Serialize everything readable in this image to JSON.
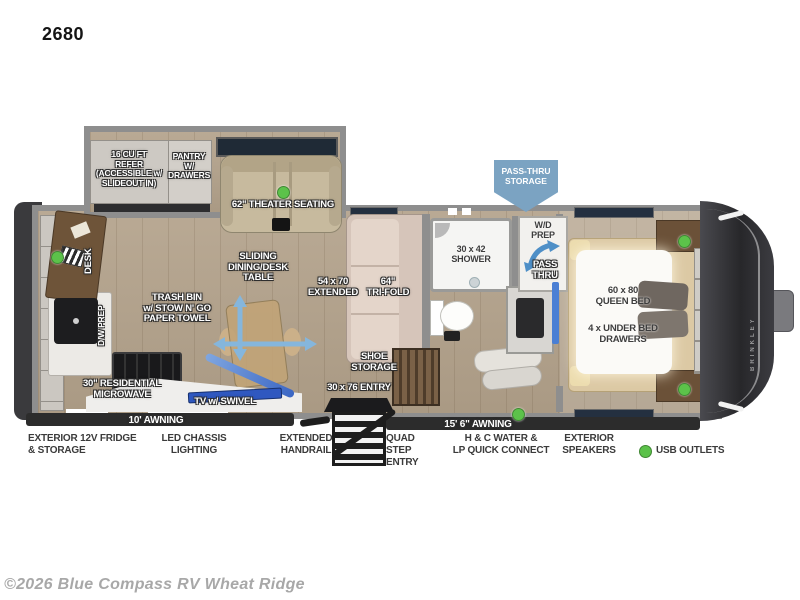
{
  "title": "2680",
  "copyright": "©2026 Blue Compass RV Wheat Ridge",
  "callouts": {
    "pass_thru_storage": "PASS-THRU\nSTORAGE"
  },
  "interior": {
    "refer": "16 CU FT\nREFER\n(ACCESSIBLE w/\nSLIDEOUT IN)",
    "pantry": "PANTRY\nW/\nDRAWERS",
    "theater": "62\" THEATER SEATING",
    "sliding_table": "SLIDING\nDINING/DESK\nTABLE",
    "extended_table": "54 x 70\nEXTENDED",
    "trifold": "64\"\nTRI-FOLD",
    "trash_bin": "TRASH BIN\nw/ STOW N' GO\nPAPER TOWEL",
    "desk": "DESK",
    "dw_prep": "D/W PREP",
    "microwave": "30\" RESIDENTIAL\nMICROWAVE",
    "tv_swivel": "TV w/ SWIVEL",
    "shoe_storage": "SHOE\nSTORAGE",
    "entry_door": "30 x 76 ENTRY",
    "shower": "30 x 42\nSHOWER",
    "wd_prep": "W/D\nPREP",
    "pass_thru": "PASS\nTHRU",
    "queen_bed": "60 x 80\nQUEEN BED",
    "under_bed": "4 x UNDER BED\nDRAWERS",
    "awning_left": "10' AWNING",
    "awning_right": "15' 6\" AWNING",
    "brand": "BRINKLEY"
  },
  "exterior": [
    {
      "id": "fridge",
      "label": "EXTERIOR 12V FRIDGE\n& STORAGE"
    },
    {
      "id": "chassis",
      "label": "LED CHASSIS\nLIGHTING"
    },
    {
      "id": "handrail",
      "label": "EXTENDED\nHANDRAIL"
    },
    {
      "id": "steps",
      "label": "QUAD STEP\nENTRY"
    },
    {
      "id": "water",
      "label": "H & C WATER &\nLP QUICK CONNECT"
    },
    {
      "id": "speakers",
      "label": "EXTERIOR\nSPEAKERS"
    }
  ],
  "legend": {
    "usb": "USB OUTLETS"
  },
  "colors": {
    "usb_green": "#5cc24a",
    "callout_blue": "#7ba3c2",
    "awning_dark": "#2c2c2c"
  }
}
